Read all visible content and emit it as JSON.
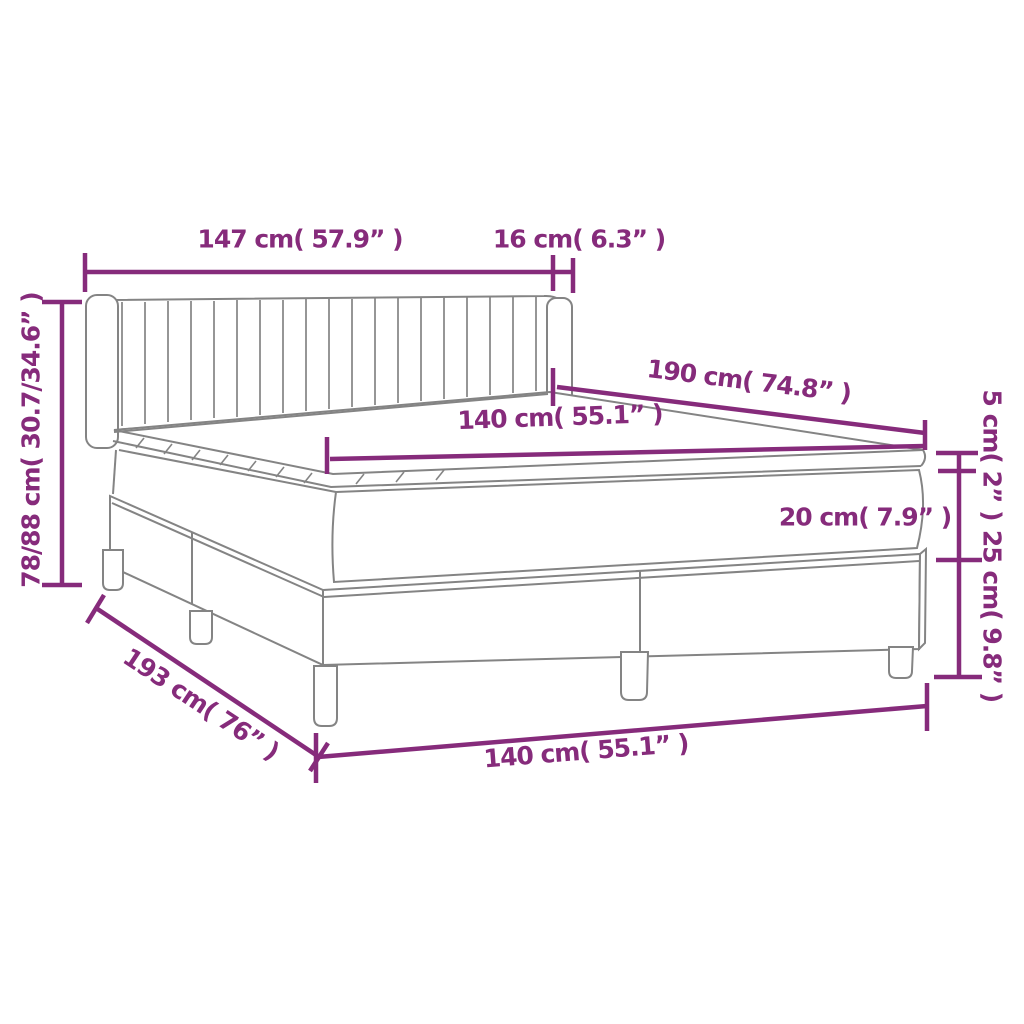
{
  "colors": {
    "accent": "#862B7B",
    "line_art": "#848484",
    "background": "#FFFFFF"
  },
  "dims": {
    "headboard_width": "147 cm( 57.9” )",
    "headboard_depth": "16 cm( 6.3” )",
    "overall_height": "78/88 cm( 30.7/34.6” )",
    "bed_length": "190 cm( 74.8” )",
    "mattress_width": "140 cm( 55.1” )",
    "topper_thickness": "5 cm( 2” )",
    "mattress_thickness": "20 cm( 7.9” )",
    "base_height": "25 cm( 9.8” )",
    "overall_length": "193 cm( 76” )",
    "base_width": "140 cm( 55.1” )"
  }
}
